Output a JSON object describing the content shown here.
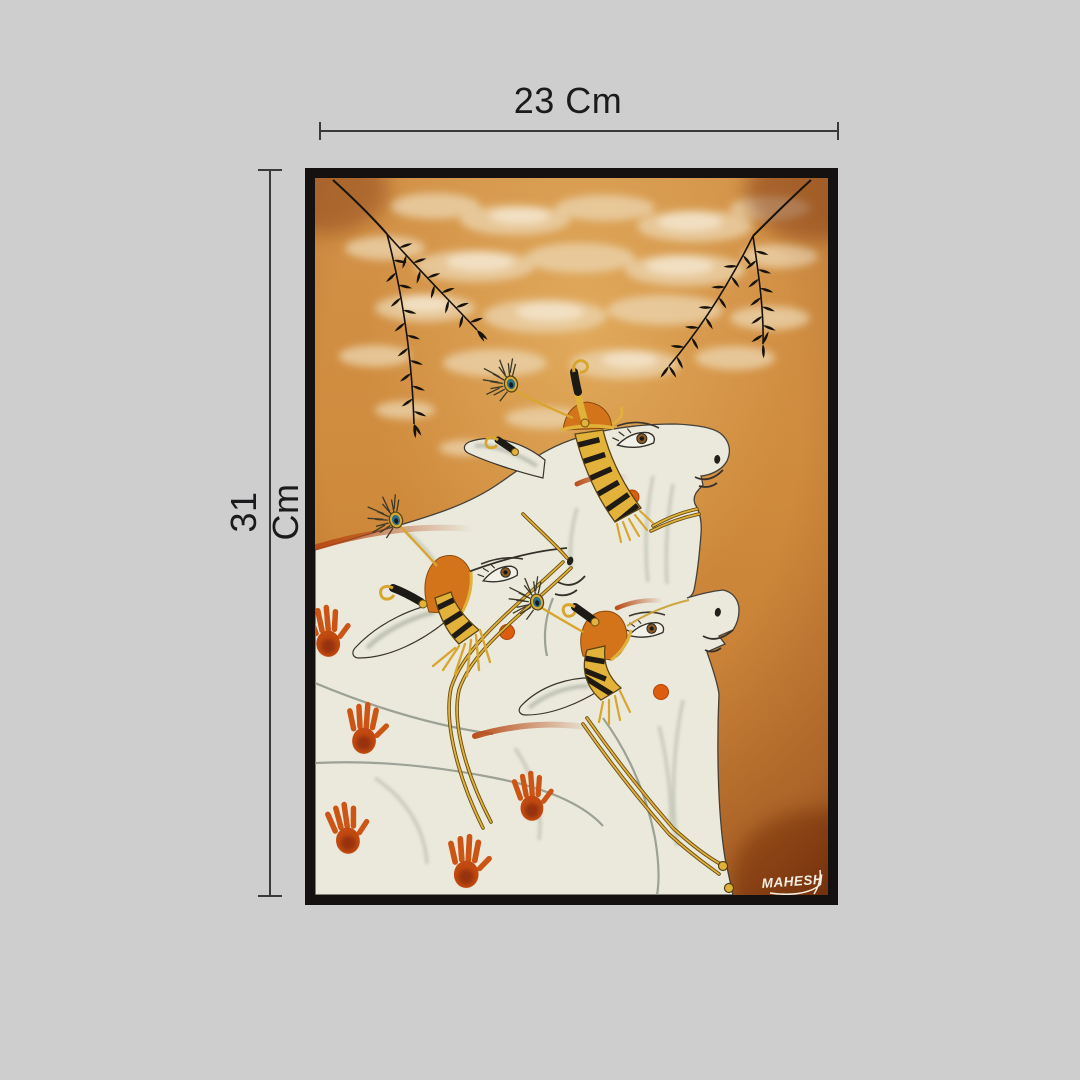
{
  "page": {
    "background_color": "#cfcecf",
    "type": "product dimension image"
  },
  "dimensions": {
    "width_label": "23 Cm",
    "height_label": "31 Cm",
    "line_color": "#3a3a3a",
    "text_color": "#1b1b1d"
  },
  "painting": {
    "signature": "MAHESH",
    "description": "Traditional Indian Pichwai-style painting of three white cows with gold-and-black striped horns, orange crowns, peacock feathers and orange handprints, under an orange sky with pale clouds and two black leafy branches",
    "frame_color": "#151110",
    "palette": {
      "sky_orange": "#cf8a3c",
      "cow_body": "#eae9dc",
      "gold": "#e0b23a",
      "crown_orange": "#d4741a",
      "handprint": "#c94e12",
      "tilak": "#dd5f10",
      "leaf_black": "#17120a"
    }
  }
}
